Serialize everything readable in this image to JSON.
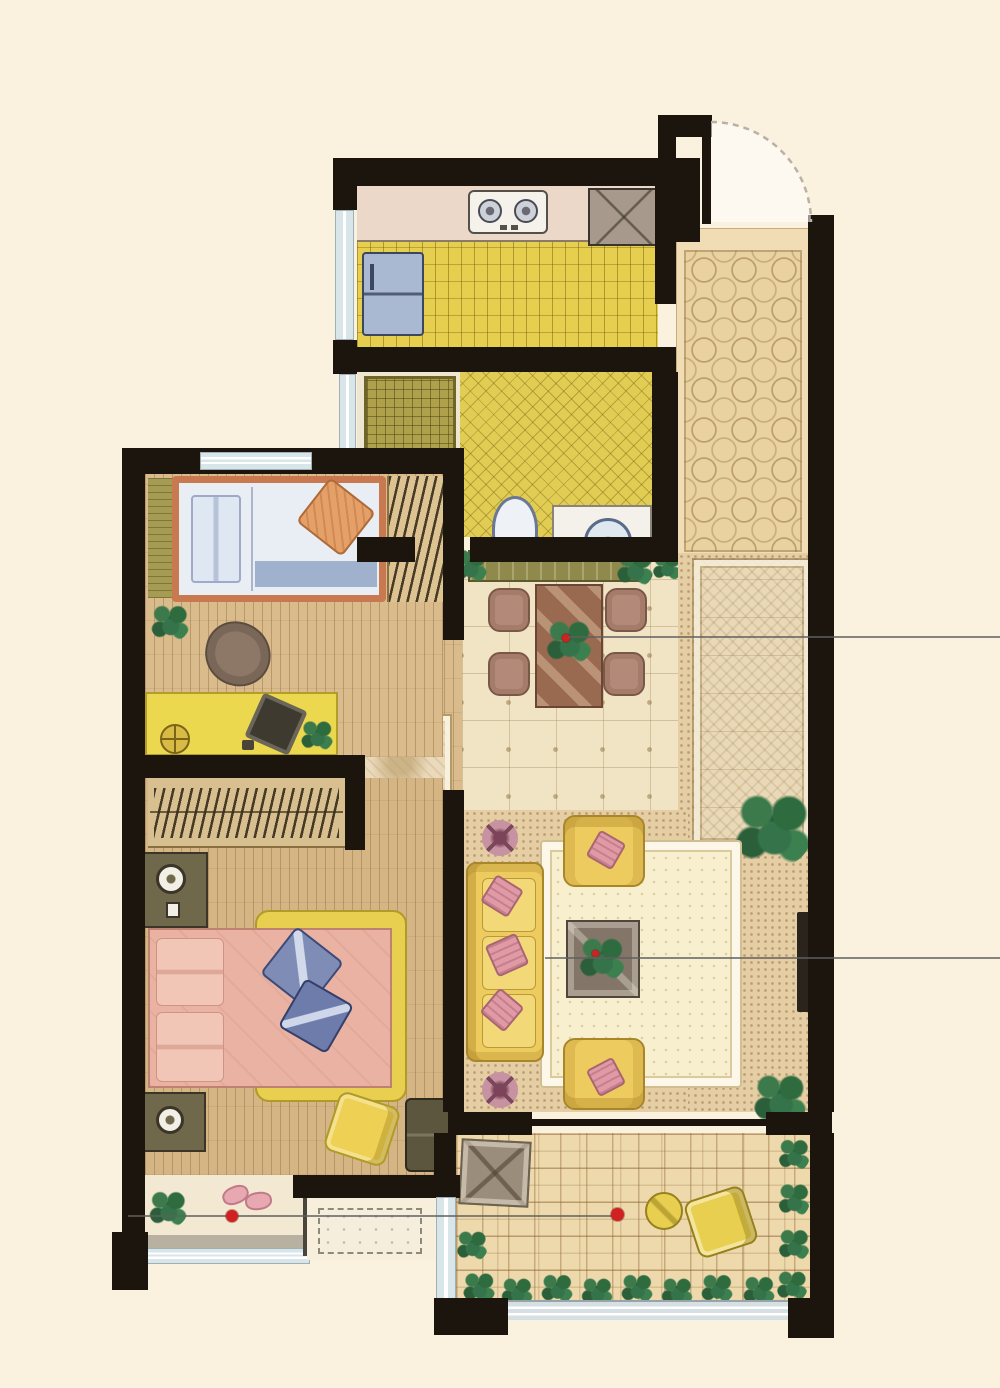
{
  "document": {
    "type": "apartment floor plan",
    "style": "hand-drawn watercolor rendering, top-down view",
    "background_color": "#FAF2DF",
    "wall_color": "#1B150E"
  },
  "palette": {
    "wood_floor": "#D9BB8C",
    "kitchen_tile": "#E6CF4E",
    "bath_tile": "#E2CD54",
    "entry_tile": "#EAD1A0",
    "dining_tile": "#F1E4C5",
    "balcony_tile": "#EED9AC",
    "rug_cream": "#F7EFCD",
    "sofa_yellow": "#EECB5E",
    "bed_pink": "#E9B2A2",
    "pillow_blue": "#7E8CB6",
    "plant_green": "#2E6B3F",
    "annotation_red": "#CF2121",
    "window_glass": "#D8E6EA"
  },
  "rooms": [
    {
      "id": "kitchen",
      "features": [
        "counter",
        "gas-stove-2-burner",
        "sink",
        "refrigerator",
        "yellow-grid-tile-floor",
        "side-window"
      ]
    },
    {
      "id": "entry-hall",
      "features": [
        "entry-door-with-swing-arc",
        "octagon-tile-floor"
      ]
    },
    {
      "id": "bathroom",
      "features": [
        "washing-area-olive-grid",
        "toilet",
        "vanity-with-round-basin",
        "yellow-crosshatch-tile"
      ]
    },
    {
      "id": "bedroom-2",
      "features": [
        "single-bed",
        "wardrobe-with-clothes",
        "chair",
        "desk-with-laptop",
        "stool",
        "plant",
        "wood-plank-floor"
      ]
    },
    {
      "id": "dining-room",
      "features": [
        "sideboard",
        "dining-table",
        "4-chairs",
        "centerpiece-plant",
        "tile-floor-with-cross-motifs"
      ]
    },
    {
      "id": "corridor",
      "features": [
        "ornate-runner-rug",
        "palm-plant"
      ]
    },
    {
      "id": "living-room",
      "features": [
        "3-seat-sofa",
        "2-armchairs",
        "coffee-table-with-plant",
        "large-cream-rug",
        "flower-stools",
        "wall-tv",
        "corner-plants"
      ]
    },
    {
      "id": "master-bedroom",
      "features": [
        "double-bed-pink",
        "blue-pillows",
        "yellow-throw",
        "wardrobe-with-hangers",
        "2-nightstands-with-lamps",
        "accent-chair",
        "dresser",
        "bay-window-with-plant-and-slippers"
      ]
    },
    {
      "id": "balcony",
      "features": [
        "maze-pattern-paving",
        "round-table",
        "chair",
        "floor-mat",
        "perimeter-shrubs",
        "glass-railing"
      ]
    },
    {
      "id": "ac-platform",
      "features": [
        "dashed-outline-area"
      ]
    }
  ],
  "annotations": {
    "red_dots": [
      {
        "x": 232,
        "y": 1216,
        "location": "bay-window"
      },
      {
        "x": 618,
        "y": 1214,
        "location": "balcony"
      }
    ],
    "leader_lines": [
      {
        "y": 637,
        "x1": 568,
        "x2": 1000,
        "location": "dining-to-right-edge"
      },
      {
        "y": 958,
        "x1": 545,
        "x2": 1000,
        "location": "living-to-right-edge"
      },
      {
        "y": 1216,
        "x1": 128,
        "x2": 618,
        "location": "bay-to-balcony"
      }
    ],
    "door_swing_arcs": [
      {
        "location": "main-entry",
        "hinge_x": 707,
        "hinge_y": 222,
        "radius": 100
      }
    ]
  },
  "text_labels": []
}
